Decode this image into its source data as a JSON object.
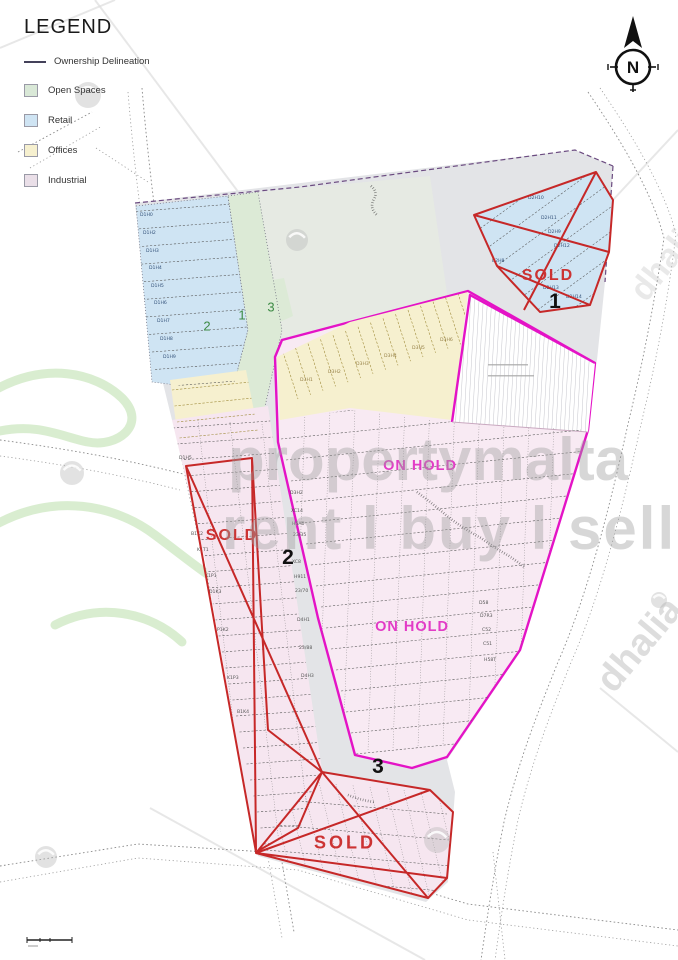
{
  "legend": {
    "title": "LEGEND",
    "items": [
      {
        "label": "Ownership Delineation",
        "type": "line",
        "color": "#44415a"
      },
      {
        "label": "Open Spaces",
        "type": "swatch",
        "color": "#d9e8d7"
      },
      {
        "label": "Retail",
        "type": "swatch",
        "color": "#cfe4f3"
      },
      {
        "label": "Offices",
        "type": "swatch",
        "color": "#f6f0cf"
      },
      {
        "label": "Industrial",
        "type": "swatch",
        "color": "#eadfe8"
      }
    ]
  },
  "compass": {
    "label": "N"
  },
  "map": {
    "zone_markers": [
      {
        "id": "1",
        "status": "SOLD"
      },
      {
        "id": "2",
        "status": "SOLD"
      },
      {
        "id": "3",
        "status": "SOLD"
      }
    ],
    "on_hold_labels": [
      "ON HOLD",
      "ON HOLD"
    ],
    "open_space_numbers": [
      "2",
      "1",
      "3"
    ],
    "plot_labels": [
      {
        "t": "D1H0",
        "x": 140,
        "y": 216,
        "c": "b"
      },
      {
        "t": "D1H2",
        "x": 143,
        "y": 234,
        "c": "b"
      },
      {
        "t": "D1H3",
        "x": 146,
        "y": 252,
        "c": "b"
      },
      {
        "t": "D1H4",
        "x": 149,
        "y": 269,
        "c": "b"
      },
      {
        "t": "D1H5",
        "x": 151,
        "y": 287,
        "c": "b"
      },
      {
        "t": "D1H6",
        "x": 154,
        "y": 304,
        "c": "b"
      },
      {
        "t": "D1H7",
        "x": 157,
        "y": 322,
        "c": "b"
      },
      {
        "t": "D1H8",
        "x": 160,
        "y": 340,
        "c": "b"
      },
      {
        "t": "D1H9",
        "x": 163,
        "y": 358,
        "c": "b"
      },
      {
        "t": "D2H10",
        "x": 528,
        "y": 199,
        "c": "b"
      },
      {
        "t": "D2H11",
        "x": 541,
        "y": 219,
        "c": "b"
      },
      {
        "t": "D2H9",
        "x": 548,
        "y": 233,
        "c": "b"
      },
      {
        "t": "D2H12",
        "x": 554,
        "y": 247,
        "c": "b"
      },
      {
        "t": "B2H8",
        "x": 492,
        "y": 262,
        "c": "b"
      },
      {
        "t": "D2H13",
        "x": 543,
        "y": 289,
        "c": "b"
      },
      {
        "t": "D2H14",
        "x": 566,
        "y": 298,
        "c": "b"
      },
      {
        "t": "D3H2",
        "x": 290,
        "y": 494,
        "c": "e"
      },
      {
        "t": "XC14",
        "x": 291,
        "y": 512,
        "c": "e"
      },
      {
        "t": "H5A0",
        "x": 292,
        "y": 525,
        "c": "e"
      },
      {
        "t": "23/35",
        "x": 293,
        "y": 536,
        "c": "e"
      },
      {
        "t": "XC8",
        "x": 292,
        "y": 563,
        "c": "e"
      },
      {
        "t": "H911",
        "x": 294,
        "y": 578,
        "c": "e"
      },
      {
        "t": "23/70",
        "x": 295,
        "y": 592,
        "c": "e"
      },
      {
        "t": "D4H1",
        "x": 297,
        "y": 621,
        "c": "e"
      },
      {
        "t": "23/88",
        "x": 299,
        "y": 649,
        "c": "e"
      },
      {
        "t": "D4H3",
        "x": 301,
        "y": 677,
        "c": "e"
      },
      {
        "t": "D1H5",
        "x": 179,
        "y": 459,
        "c": "e"
      },
      {
        "t": "B1K2",
        "x": 191,
        "y": 535,
        "c": "e"
      },
      {
        "t": "K1T1",
        "x": 197,
        "y": 551,
        "c": "e"
      },
      {
        "t": "K1P1",
        "x": 205,
        "y": 577,
        "c": "e"
      },
      {
        "t": "D1K3",
        "x": 209,
        "y": 593,
        "c": "e"
      },
      {
        "t": "P1K2",
        "x": 217,
        "y": 631,
        "c": "e"
      },
      {
        "t": "K1P3",
        "x": 227,
        "y": 679,
        "c": "e"
      },
      {
        "t": "B1K4",
        "x": 237,
        "y": 713,
        "c": "e"
      },
      {
        "t": "D58",
        "x": 479,
        "y": 604,
        "c": "e"
      },
      {
        "t": "D7R3",
        "x": 480,
        "y": 617,
        "c": "e"
      },
      {
        "t": "C52",
        "x": 482,
        "y": 631,
        "c": "e"
      },
      {
        "t": "C51",
        "x": 483,
        "y": 645,
        "c": "e"
      },
      {
        "t": "H58T",
        "x": 484,
        "y": 661,
        "c": "e"
      },
      {
        "t": "D3H1",
        "x": 300,
        "y": 381,
        "c": "y"
      },
      {
        "t": "D3H2",
        "x": 328,
        "y": 373,
        "c": "y"
      },
      {
        "t": "D3H3",
        "x": 356,
        "y": 365,
        "c": "y"
      },
      {
        "t": "D3H4",
        "x": 384,
        "y": 357,
        "c": "y"
      },
      {
        "t": "D3H5",
        "x": 412,
        "y": 349,
        "c": "y"
      },
      {
        "t": "D3H6",
        "x": 440,
        "y": 341,
        "c": "y"
      }
    ]
  },
  "watermarks": {
    "brand": "propertymalta",
    "tagline": "rent l buy l sell",
    "agency": "dhalia",
    "agency_secondary": "dhalia"
  },
  "colors": {
    "magenta": "#e413c6",
    "red": "#c62828",
    "sold": "#cc3333",
    "onhold": "#e23cc6",
    "retail": "#cfe4f3",
    "offices": "#f6f0cf",
    "industrial": "#f6e6f0",
    "industrial_light": "#f8eaf3",
    "open": "#dcead6",
    "parcel": "#e3e4e7",
    "opennum": "#3c8a44"
  }
}
